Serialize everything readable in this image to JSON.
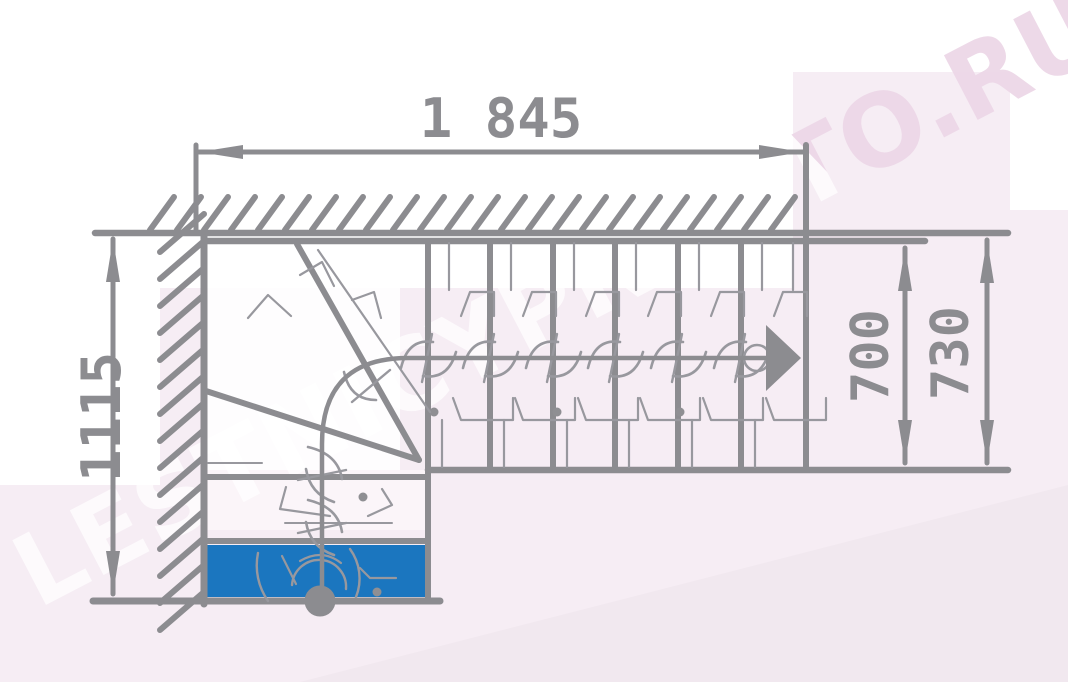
{
  "title": "L-shaped winder staircase plan drawing",
  "watermark": {
    "text": "LESTNICYPROSTO.RU"
  },
  "dimensions": {
    "top_width": {
      "label": "1 845",
      "unit": "mm"
    },
    "left_height": {
      "label": "1115",
      "unit": "mm"
    },
    "flight_width_inner": {
      "label": "700",
      "unit": "mm"
    },
    "flight_width_outer": {
      "label": "730",
      "unit": "mm"
    }
  },
  "plan": {
    "straight_treads": 6,
    "winder_treads": 3,
    "lower_treads": 2,
    "first_step_highlighted": true,
    "walk_direction": "up then right"
  },
  "colors": {
    "line": "#8c8c90",
    "ghost": "#98989e",
    "accent_blue": "#1b76bf",
    "bg_pink": "#f6edf4",
    "bg_white": "#ffffff",
    "watermark_pink": "#ecd7e7"
  }
}
